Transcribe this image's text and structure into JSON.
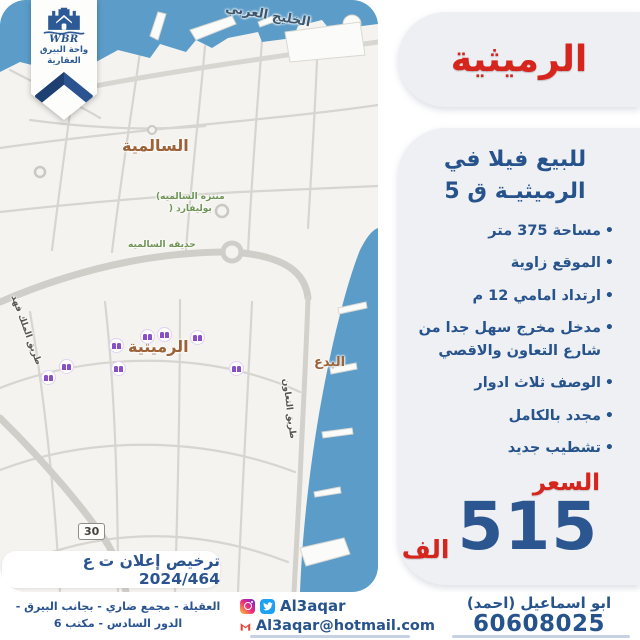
{
  "logo": {
    "acronym": "WBR",
    "name_line1": "واحة البيرق",
    "name_line2": "العقارية"
  },
  "panel": {
    "title": "الرميثية",
    "subtitle_line1": "للبيع فيلا في",
    "subtitle_line2": "الرميثيـة ق 5",
    "features": [
      "مساحة 375 متر",
      "الموقع زاوية",
      "ارتداد امامي 12 م",
      "مدخل مخرج سهل جدا من شارع التعاون والاقصي",
      "الوصف ثلاث ادوار",
      "مجدد بالكامل",
      "تشطيب جديد"
    ],
    "price_label": "السعر",
    "price_value": "515",
    "price_unit": "الف"
  },
  "map": {
    "license_text": "ترخيص إعلان ت ع 2024/464",
    "route_shield": "30",
    "labels": {
      "sea": "الخليج العربي",
      "salmiya": "السالمية",
      "rumaithiya": "الرميثية",
      "bidaa": "البدع",
      "park": "حديقه السالميه",
      "boulevard_line1": "(منتزه السالميه",
      "boulevard_line2": ") بوليفارد",
      "taawun_road": "طريق التعاون",
      "king_fahd_road": "طريق الملك فهد",
      "partial_label": "حرب"
    }
  },
  "footer": {
    "address_line1": "العقيلة - مجمع ضاري - بجانب البيرق -",
    "address_line2": "الدور السادس - مكتب 6",
    "social_handle": "Al3aqar",
    "email": "Al3aqar@hotmail.com",
    "agent_name": "ابو اسماعيل (احمد)",
    "agent_phone": "60608025"
  },
  "colors": {
    "accent_red": "#d6251d",
    "accent_blue": "#27538c",
    "water_blue": "#5b9cc9",
    "pill_gray": "#eef0f4"
  }
}
